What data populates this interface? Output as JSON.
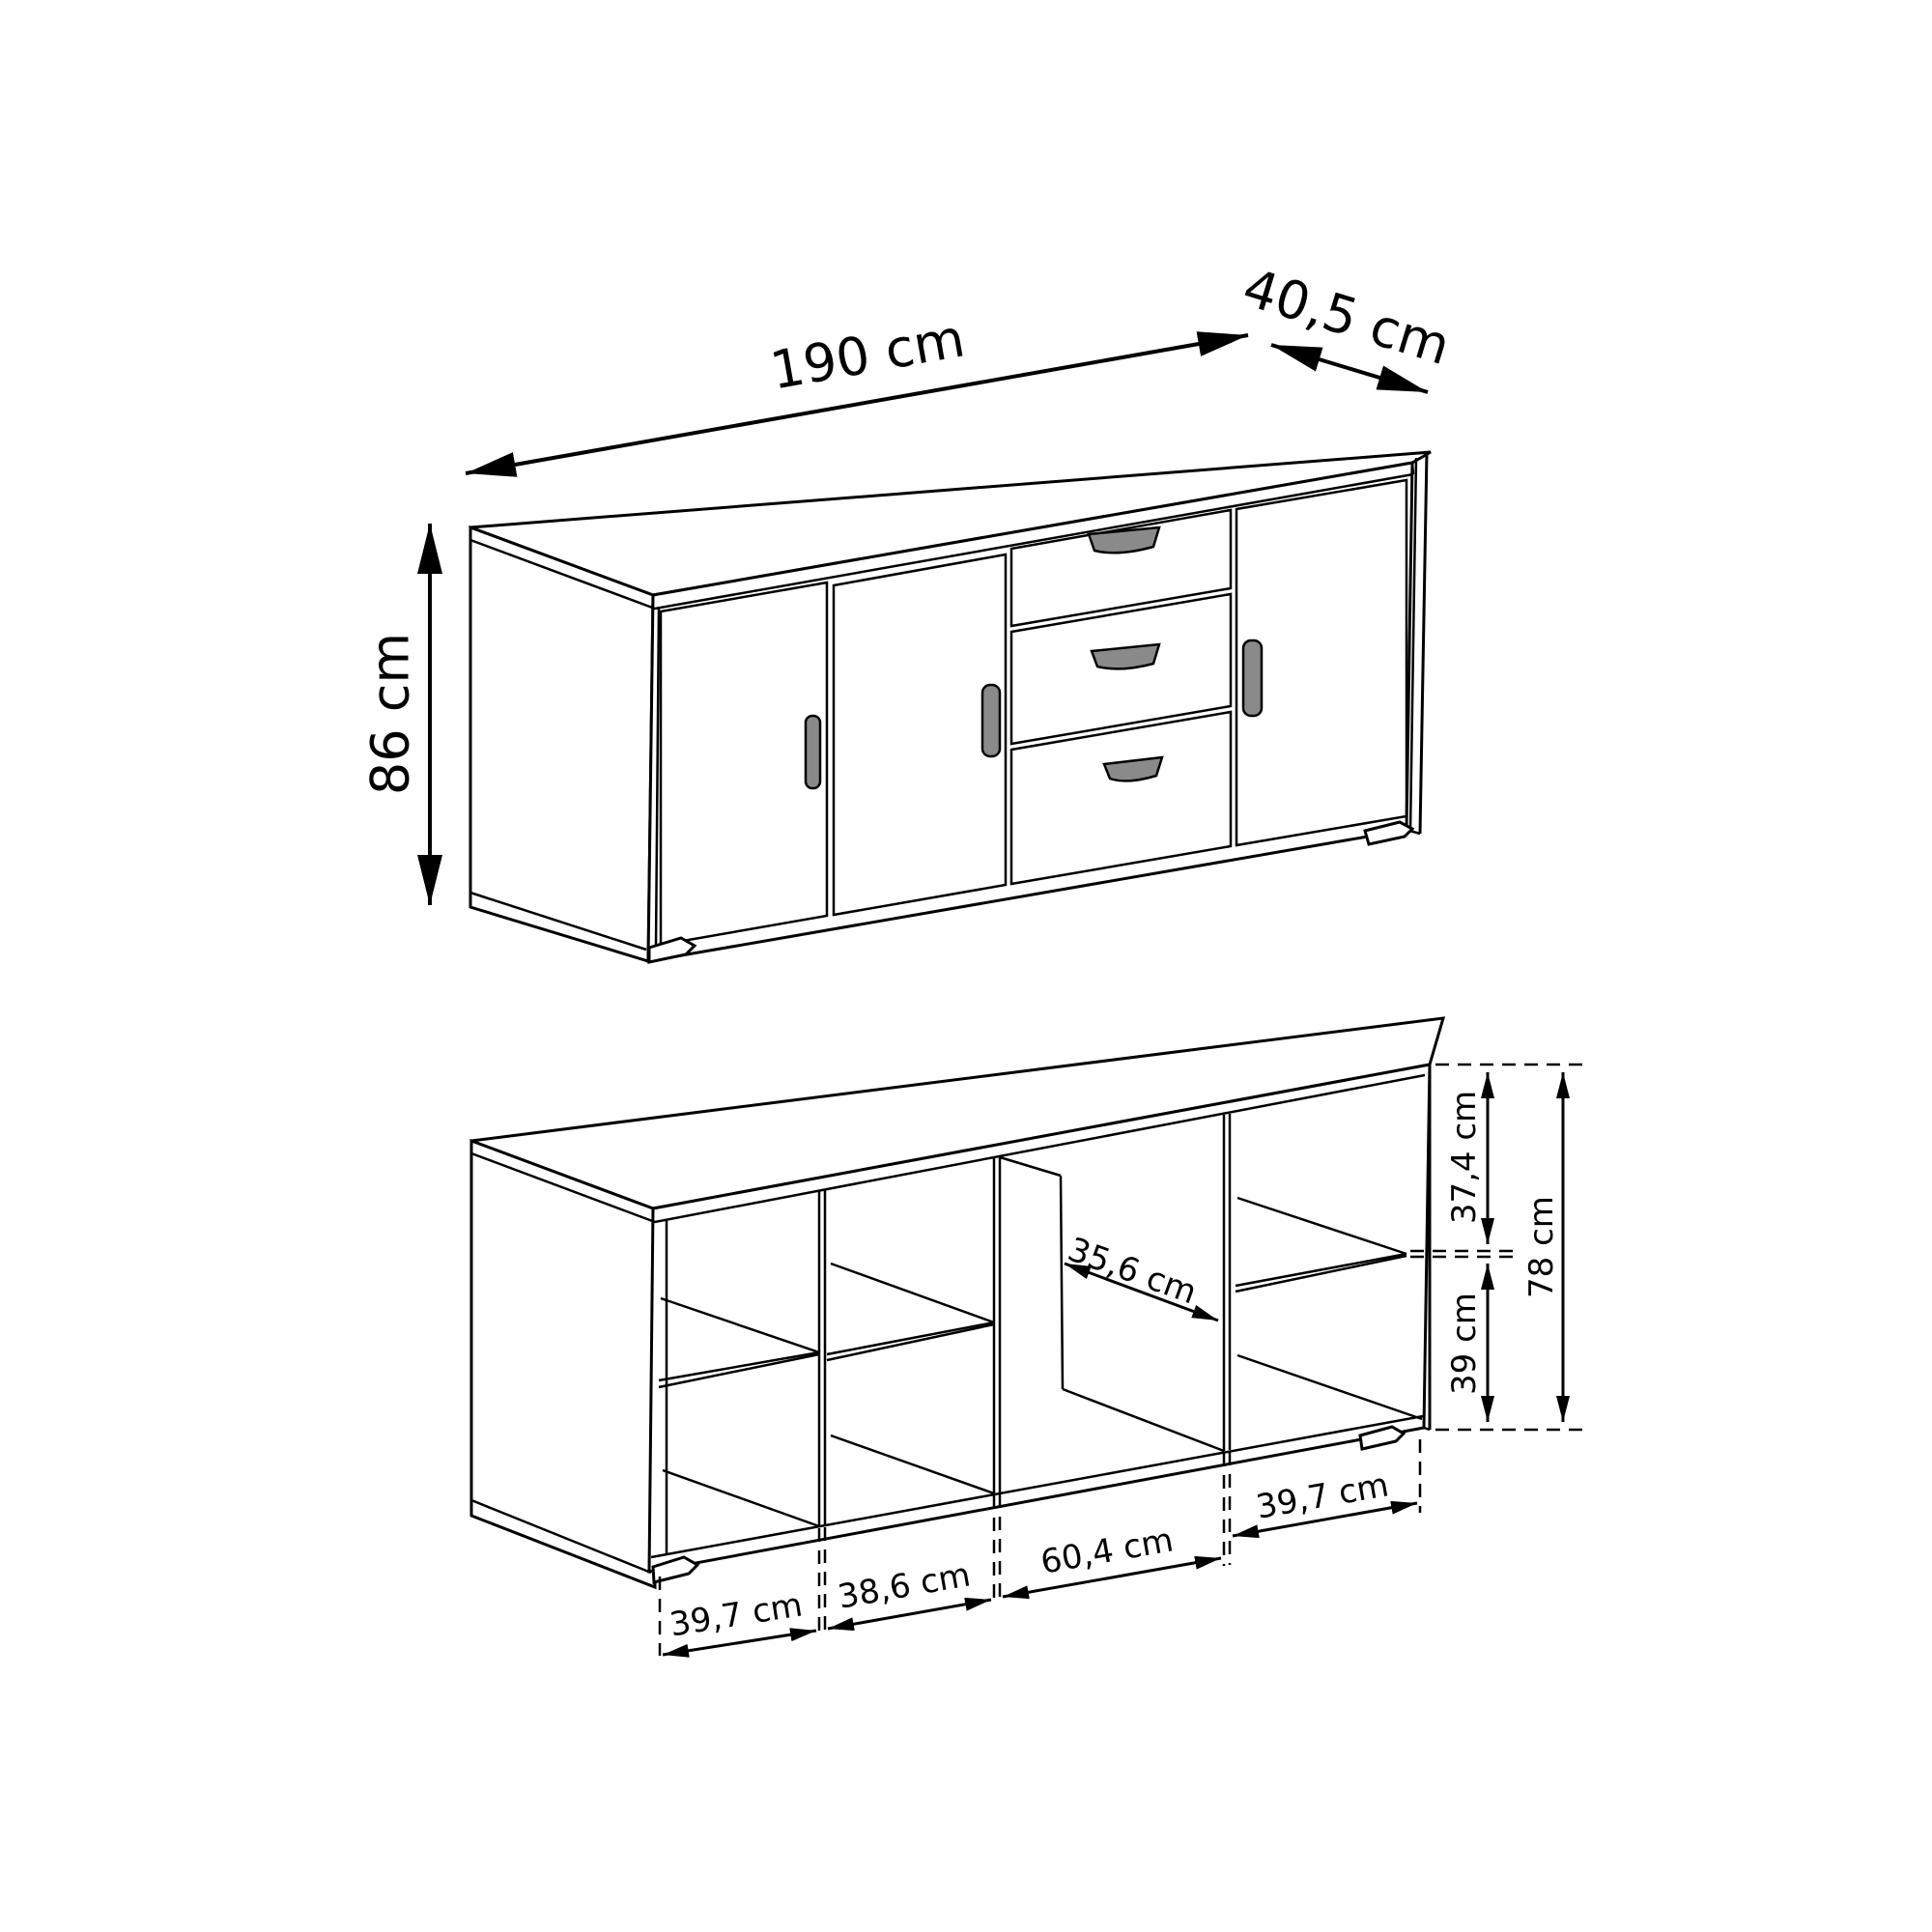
{
  "dimensions": {
    "overall": {
      "width": "190 cm",
      "depth": "40,5 cm",
      "height": "86 cm"
    },
    "interior": {
      "upper_compartment_height": "37,4 cm",
      "lower_compartment_height": "39 cm",
      "interior_height": "78 cm",
      "interior_depth": "35,6 cm",
      "compartment_widths": [
        "39,7 cm",
        "38,6 cm",
        "60,4 cm",
        "39,7 cm"
      ]
    }
  },
  "colors": {
    "line": "#000000",
    "handle_fill": "#8a8a8a",
    "background": "#ffffff"
  }
}
